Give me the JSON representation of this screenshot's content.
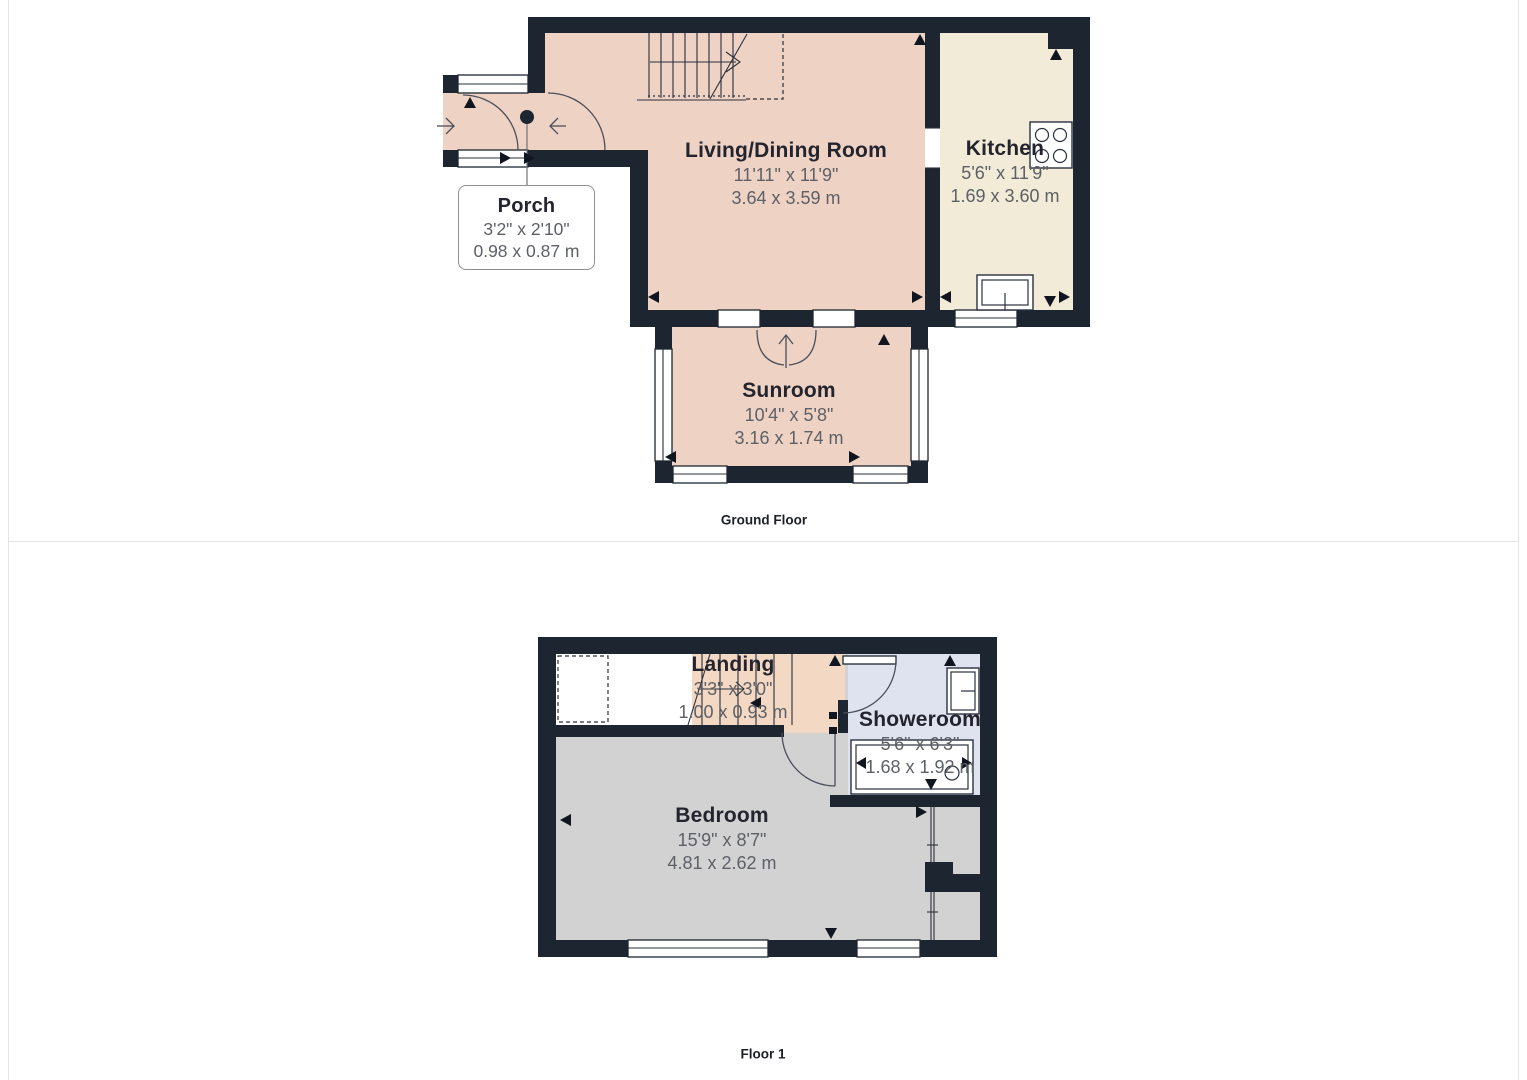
{
  "ground_floor": {
    "label": "Ground Floor",
    "rooms": [
      {
        "name": "Porch",
        "dims_imperial": "3'2\" x 2'10\"",
        "dims_metric": "0.98 x 0.87 m"
      },
      {
        "name": "Living/Dining Room",
        "dims_imperial": "11'11\" x 11'9\"",
        "dims_metric": "3.64 x 3.59 m"
      },
      {
        "name": "Kitchen",
        "dims_imperial": "5'6\" x 11'9\"",
        "dims_metric": "1.69 x 3.60 m"
      },
      {
        "name": "Sunroom",
        "dims_imperial": "10'4\" x 5'8\"",
        "dims_metric": "3.16 x 1.74 m"
      }
    ]
  },
  "floor_1": {
    "label": "Floor 1",
    "rooms": [
      {
        "name": "Landing",
        "dims_imperial": "3'3\" x 3'0\"",
        "dims_metric": "1.00 x 0.93 m"
      },
      {
        "name": "Showeroom",
        "dims_imperial": "5'6\" x 6'3\"",
        "dims_metric": "1.68 x 1.92 m"
      },
      {
        "name": "Bedroom",
        "dims_imperial": "15'9\" x 8'7\"",
        "dims_metric": "4.81 x 2.62 m"
      }
    ]
  },
  "colors": {
    "wall": "#1d2531",
    "room_pink": "#eed3c5",
    "room_peach": "#f3d8c4",
    "room_cream": "#f1ebd7",
    "room_blue": "#dfe3ef",
    "room_gray": "#d2d2d2"
  }
}
